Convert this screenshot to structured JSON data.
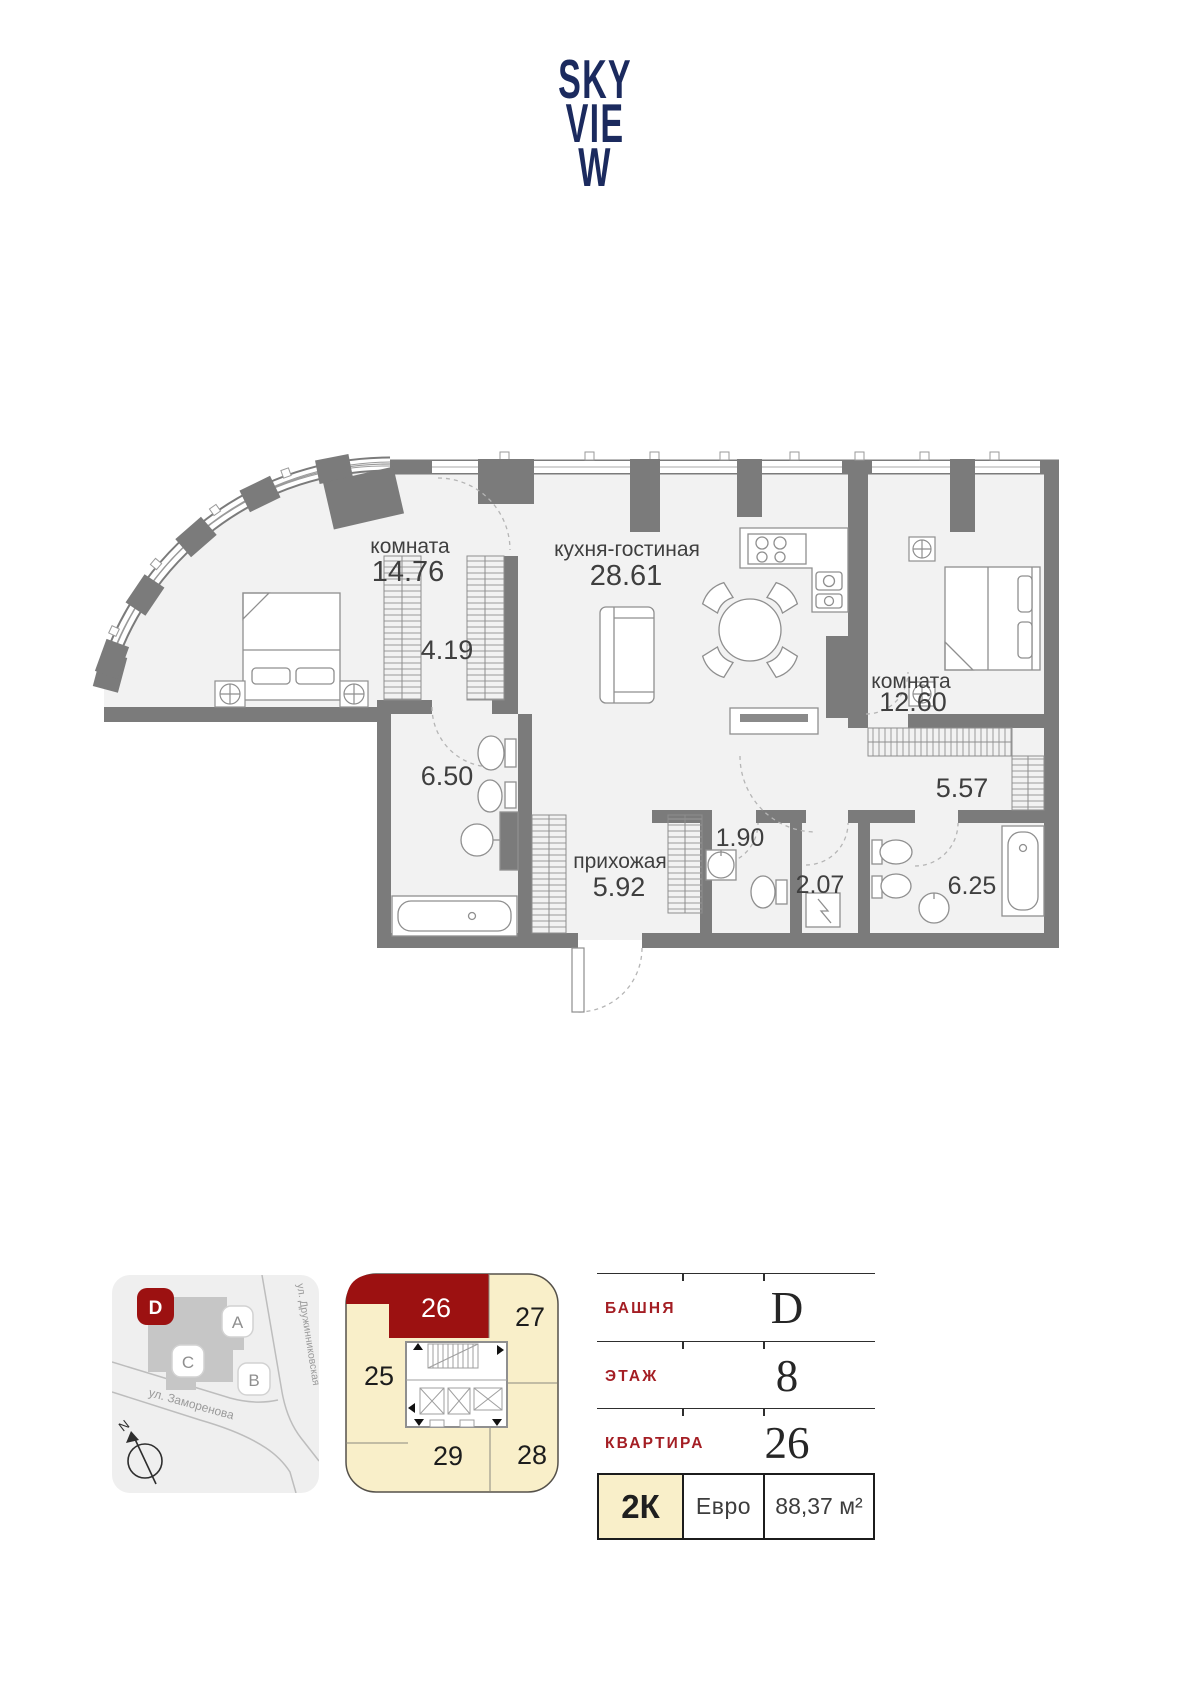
{
  "logo": {
    "line1": "SKY",
    "line2": "VIE",
    "line3": "W"
  },
  "plan": {
    "room1_name": "комната",
    "room1_area": "14.76",
    "kitchen_name": "кухня-гостиная",
    "kitchen_area": "28.61",
    "lobby_area": "4.19",
    "room2_name": "комната",
    "room2_area": "12.60",
    "bath1_area": "6.50",
    "closet_area": "5.57",
    "hall_name": "прихожая",
    "hall_area": "5.92",
    "wc1_area": "1.90",
    "wc2_area": "2.07",
    "bath2_area": "6.25"
  },
  "site_map": {
    "tower_d": "D",
    "tower_a": "A",
    "tower_c": "C",
    "tower_b": "B",
    "street1": "ул. Дружинниковская",
    "street2": "ул. Заморенова",
    "compass": "N"
  },
  "key_plan": {
    "unit25": "25",
    "unit26": "26",
    "unit27": "27",
    "unit28": "28",
    "unit29": "29",
    "highlighted_unit": "26"
  },
  "info": {
    "row1_label": "БАШНЯ",
    "row1_value": "D",
    "row2_label": "ЭТАЖ",
    "row2_value": "8",
    "row3_label": "КВАРТИРА",
    "row3_value": "26",
    "rooms": "2К",
    "layout": "Евро",
    "area": "88,37 м²"
  },
  "colors": {
    "accent_red": "#9c1111",
    "navy": "#1b2a5e",
    "cream": "#f9efc9"
  }
}
